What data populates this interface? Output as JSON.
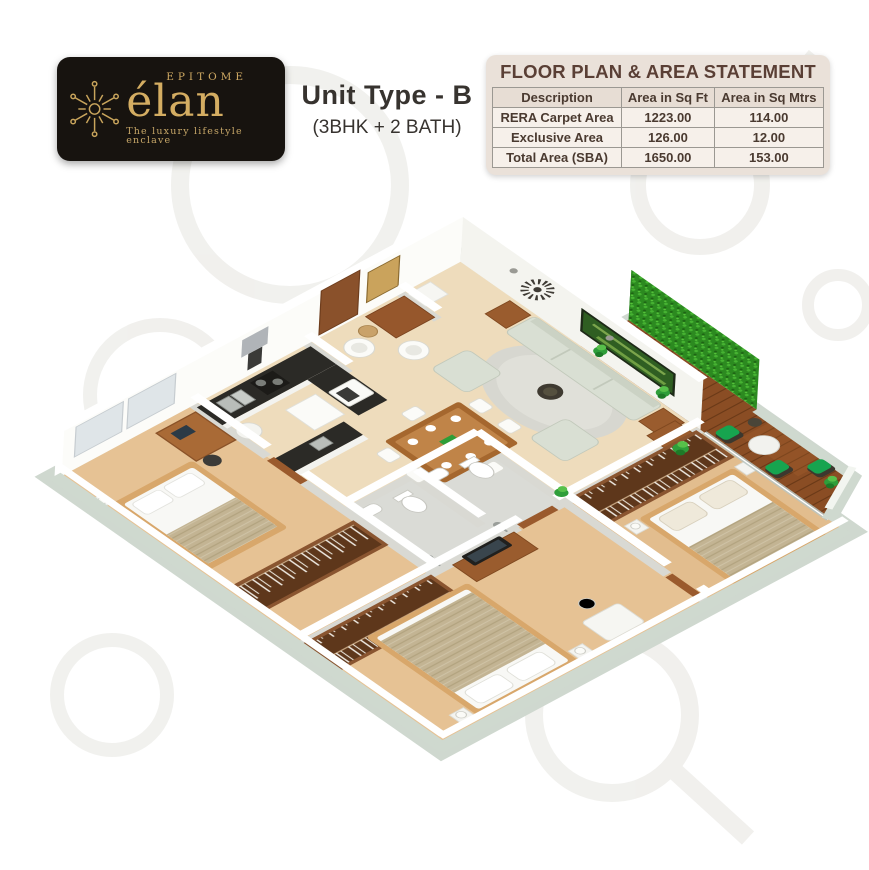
{
  "logo": {
    "brand_prefix": "EPITOME",
    "brand": "élan",
    "tagline": "The luxury lifestyle enclave",
    "card_bg": "#17130f",
    "gold": "#c9a55c"
  },
  "unit": {
    "title": "Unit Type - B",
    "subtitle": "(3BHK + 2 BATH)"
  },
  "area_statement": {
    "title": "FLOOR PLAN & AREA STATEMENT",
    "columns": [
      "Description",
      "Area in Sq Ft",
      "Area in Sq Mtrs"
    ],
    "rows": [
      {
        "description": "RERA Carpet Area",
        "sqft": "1223.00",
        "sqmtrs": "114.00"
      },
      {
        "description": "Exclusive Area",
        "sqft": "126.00",
        "sqmtrs": "12.00"
      },
      {
        "description": "Total Area (SBA)",
        "sqft": "1650.00",
        "sqmtrs": "153.00"
      }
    ]
  },
  "floor_plan": {
    "type": "3d-isometric-apartment-render",
    "rooms": [
      "Foyer",
      "Kitchen",
      "Dining",
      "Living Room",
      "Bedroom 2",
      "Bedroom 3",
      "Master Bedroom",
      "Bathroom 1",
      "Bathroom 2",
      "Wooden Deck Sit-out"
    ],
    "palette": {
      "bedroom_floor": "#e6c294",
      "hall_floor": "#eedcbc",
      "bathroom_floor": "#dadbd6",
      "walls": "#ffffff",
      "slab_edge": "#cfd8cf",
      "deck_wood": "#8a4d24",
      "hedge_green": "#2c8a20",
      "sofa": "#d9dfd3",
      "furniture_wood": "#9a5c2e",
      "counter_top": "#2b2a26",
      "outdoor_chair_green": "#17a44f"
    }
  }
}
